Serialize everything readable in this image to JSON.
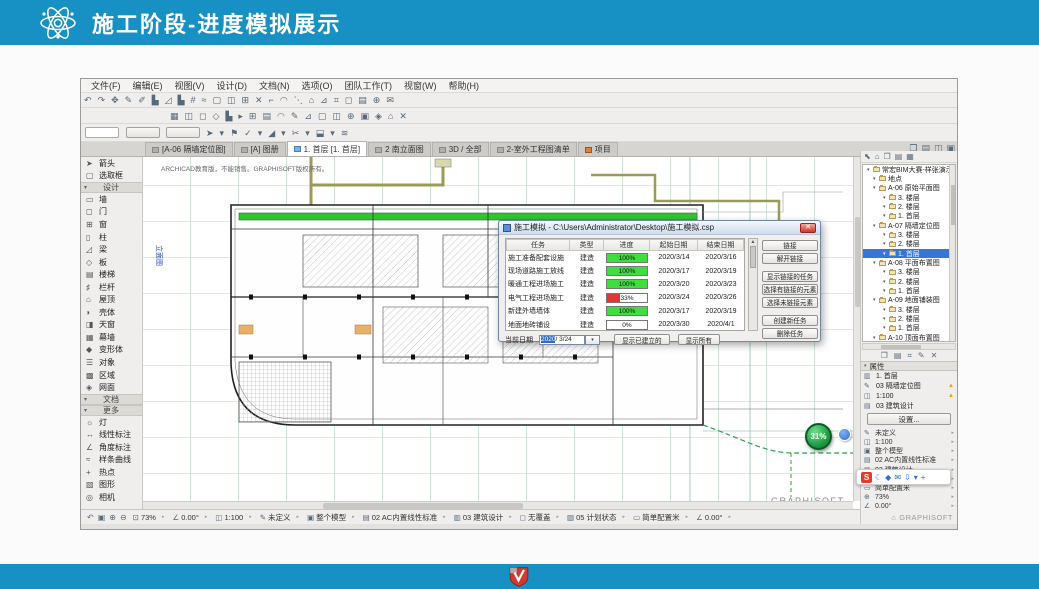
{
  "colors": {
    "accent": "#1791c4",
    "progress_green": "#3ede3e",
    "progress_red": "#e23636",
    "selection_blue": "#3875d7"
  },
  "slide": {
    "title": "施工阶段-进度模拟展示"
  },
  "menu": {
    "items": [
      "文件(F)",
      "编辑(E)",
      "视图(V)",
      "设计(D)",
      "文档(N)",
      "选项(O)",
      "团队工作(T)",
      "视窗(W)",
      "帮助(H)"
    ]
  },
  "toolbar": {
    "row1": [
      "↶",
      "↷",
      "✥",
      "✎",
      "✐",
      "▙",
      "◿",
      "▙",
      "#",
      "≈",
      "▢",
      "◫",
      "⊞",
      "✕",
      "⌐",
      "◠",
      "⋱",
      "⌂",
      "⊿",
      "⌗",
      "◻",
      "▤",
      "⊕",
      "✉"
    ],
    "row2": [
      "▦",
      "◫",
      "◻",
      "◇",
      "▙",
      "▸",
      "⊞",
      "▤",
      "◠",
      "✎",
      "⊿",
      "▢",
      "◫",
      "⊕",
      "▣",
      "◈",
      "⌂",
      "✕"
    ],
    "row3": [
      "➤",
      "▾",
      "⚑",
      "✓",
      "▾",
      "◢",
      "▾",
      "✂",
      "▾",
      "⬓",
      "▾",
      "≋"
    ]
  },
  "tabs": {
    "items": [
      {
        "label": "[A-06 隔墙定位图]",
        "active": false
      },
      {
        "label": "[A] 图册",
        "active": false
      },
      {
        "label": "1. 首层 [1. 首层]",
        "active": true
      },
      {
        "label": "2 南立面图",
        "active": false
      },
      {
        "label": "3D / 全部",
        "active": false
      },
      {
        "label": "2-室外工程图清单",
        "active": false
      },
      {
        "label": "项目",
        "active": false,
        "ic": "orange"
      }
    ],
    "right_icons": [
      "❐",
      "▤",
      "◫",
      "▣"
    ]
  },
  "toolbox": {
    "rows": [
      {
        "type": "item",
        "glyph": "➤",
        "label": "箭头"
      },
      {
        "type": "item",
        "glyph": "▢",
        "label": "选取框"
      },
      {
        "type": "header",
        "label": "设计"
      },
      {
        "type": "item",
        "glyph": "▭",
        "label": "墙"
      },
      {
        "type": "item",
        "glyph": "◻",
        "label": "门"
      },
      {
        "type": "item",
        "glyph": "⊞",
        "label": "窗"
      },
      {
        "type": "item",
        "glyph": "▯",
        "label": "柱"
      },
      {
        "type": "item",
        "glyph": "◿",
        "label": "梁"
      },
      {
        "type": "item",
        "glyph": "◇",
        "label": "板"
      },
      {
        "type": "item",
        "glyph": "▤",
        "label": "楼梯"
      },
      {
        "type": "item",
        "glyph": "♯",
        "label": "栏杆"
      },
      {
        "type": "item",
        "glyph": "⌂",
        "label": "屋顶"
      },
      {
        "type": "item",
        "glyph": "◗",
        "label": "壳体"
      },
      {
        "type": "item",
        "glyph": "◨",
        "label": "天窗"
      },
      {
        "type": "item",
        "glyph": "▦",
        "label": "幕墙"
      },
      {
        "type": "item",
        "glyph": "◆",
        "label": "变形体"
      },
      {
        "type": "item",
        "glyph": "☰",
        "label": "对象"
      },
      {
        "type": "item",
        "glyph": "▩",
        "label": "区域"
      },
      {
        "type": "item",
        "glyph": "◈",
        "label": "网面"
      },
      {
        "type": "header",
        "label": "文档"
      },
      {
        "type": "header",
        "label": "更多"
      },
      {
        "type": "item",
        "glyph": "☼",
        "label": "灯"
      },
      {
        "type": "item",
        "glyph": "↔",
        "label": "线性标注"
      },
      {
        "type": "item",
        "glyph": "∠",
        "label": "角度标注"
      },
      {
        "type": "item",
        "glyph": "≈",
        "label": "样条曲线"
      },
      {
        "type": "item",
        "glyph": "+",
        "label": "热点"
      },
      {
        "type": "item",
        "glyph": "▧",
        "label": "图形"
      },
      {
        "type": "item",
        "glyph": "◎",
        "label": "相机"
      }
    ]
  },
  "canvas": {
    "watermark": "ARCHICAD教育版，不能销售。GRAPHISOFT版权所有。",
    "brand": "GRAPHISOFT.",
    "vertical_label": "立面图",
    "badge": "31%"
  },
  "dialog": {
    "title": "施工模拟 - C:\\Users\\Administrator\\Desktop\\施工模拟.csp",
    "close": "✕",
    "columns": [
      "任务",
      "类型",
      "进度",
      "起始日期",
      "结束日期"
    ],
    "rows": [
      {
        "task": "施工准备配套设施",
        "type": "建造",
        "progress": "100%",
        "start": "2020/3/14",
        "end": "2020/3/16"
      },
      {
        "task": "现场道路施工放线",
        "type": "建造",
        "progress": "100%",
        "start": "2020/3/17",
        "end": "2020/3/19"
      },
      {
        "task": "暖通工程进场施工",
        "type": "建造",
        "progress": "100%",
        "start": "2020/3/20",
        "end": "2020/3/23"
      },
      {
        "task": "电气工程进场施工",
        "type": "建造",
        "progress": "33%",
        "start": "2020/3/24",
        "end": "2020/3/26"
      },
      {
        "task": "新建外墙墙体",
        "type": "建造",
        "progress": "100%",
        "start": "2020/3/17",
        "end": "2020/3/19"
      },
      {
        "task": "地面地砖铺设",
        "type": "建造",
        "progress": "0%",
        "start": "2020/3/30",
        "end": "2020/4/1"
      }
    ],
    "side_buttons": [
      "链接",
      "解开链接",
      "显示链接的任务",
      "选择有链接的元素",
      "选择未链接元素",
      "创建新任务",
      "删除任务"
    ],
    "current_date_label": "当前日期",
    "date_year": "2020",
    "date_rest": "/ 3/24",
    "show_built": "显示已建立的",
    "show_all": "显示所有"
  },
  "navigator": {
    "header_icons": [
      "⬉",
      "⌂",
      "❐",
      "▤",
      "▦"
    ],
    "root": "常宏BIM大赛-样张演示",
    "tree": [
      {
        "label": "地点",
        "level": 1
      },
      {
        "label": "A-06 原始平面图",
        "level": 1
      },
      {
        "label": "3. 楼层",
        "level": 2
      },
      {
        "label": "2. 楼层",
        "level": 2
      },
      {
        "label": "1. 首层",
        "level": 2
      },
      {
        "label": "A-07 隔墙定位图",
        "level": 1
      },
      {
        "label": "3. 楼层",
        "level": 2
      },
      {
        "label": "2. 楼层",
        "level": 2
      },
      {
        "label": "1. 首层",
        "level": 2,
        "selected": true
      },
      {
        "label": "A-08 平面布置图",
        "level": 1
      },
      {
        "label": "3. 楼层",
        "level": 2
      },
      {
        "label": "2. 楼层",
        "level": 2
      },
      {
        "label": "1. 首层",
        "level": 2
      },
      {
        "label": "A-09 地面铺装图",
        "level": 1
      },
      {
        "label": "3. 楼层",
        "level": 2
      },
      {
        "label": "2. 楼层",
        "level": 2
      },
      {
        "label": "1. 首层",
        "level": 2
      },
      {
        "label": "A-10 顶面布置图",
        "level": 1
      }
    ],
    "action_icons": [
      "❐",
      "▤",
      "⌗",
      "✎",
      "✕"
    ],
    "properties_header": "属性",
    "properties": [
      {
        "glyph": "▥",
        "label": "1. 首层"
      },
      {
        "glyph": "✎",
        "label": "03 隔墙定位图",
        "warn": true
      },
      {
        "glyph": "◫",
        "label": "1:100",
        "warn": true
      },
      {
        "glyph": "▤",
        "label": "03 建筑设计"
      }
    ],
    "settings_button": "设置...",
    "quick_options": [
      {
        "glyph": "✎",
        "label": "未定义"
      },
      {
        "glyph": "◫",
        "label": "1:100"
      },
      {
        "glyph": "▣",
        "label": "整个模型"
      },
      {
        "glyph": "▤",
        "label": "02 AC内置线性标准"
      },
      {
        "glyph": "▥",
        "label": "03 建筑设计"
      },
      {
        "glyph": "▧",
        "label": "05 计划状态"
      },
      {
        "glyph": "▭",
        "label": "简单配置米"
      },
      {
        "glyph": "⊕",
        "label": "73%"
      },
      {
        "glyph": "∠",
        "label": "0.00°"
      }
    ],
    "brand": "GRAPHISOFT"
  },
  "statusbar": {
    "nav_icons": [
      "↶",
      "▣",
      "⊕",
      "⊖"
    ],
    "items": [
      {
        "glyph": "⊡",
        "label": "73%"
      },
      {
        "glyph": "∠",
        "label": "0.00°"
      },
      {
        "glyph": "◫",
        "label": "1:100"
      },
      {
        "glyph": "✎",
        "label": "未定义"
      },
      {
        "glyph": "▣",
        "label": "整个模型"
      },
      {
        "glyph": "▤",
        "label": "02 AC内置线性标准"
      },
      {
        "glyph": "▥",
        "label": "03 建筑设计"
      },
      {
        "glyph": "◻",
        "label": "无覆盖"
      },
      {
        "glyph": "▧",
        "label": "05 计划状态"
      },
      {
        "glyph": "▭",
        "label": "简单配置米"
      },
      {
        "glyph": "∠",
        "label": "0.00°"
      }
    ]
  },
  "capture": {
    "logo": "S",
    "icons": [
      "☾",
      "◆",
      "✉",
      "⇩",
      "▾",
      "+"
    ]
  }
}
